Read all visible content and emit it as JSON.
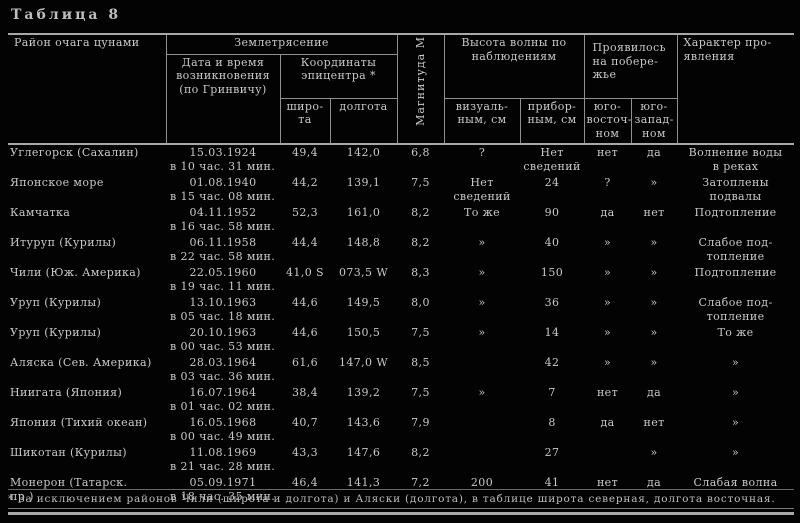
{
  "page": {
    "table_label": "Таблица 8",
    "footnote": "* За исключением районов Чили (широта и долгота) и Аляски (долгота), в таблице широта северная, долгота восточная."
  },
  "colors": {
    "background": "#030303",
    "text": "#c8c8c8",
    "rule": "#a8a8a8"
  },
  "table": {
    "headers": {
      "region": "Район очага цунами",
      "earthquake": "Землетрясение",
      "datetime": "Дата и время\nвозникновения\n(по Гринвичу)",
      "coordinates": "Координаты\nэпицентра *",
      "latitude": "широ-\nта",
      "longitude": "долгота",
      "magnitude": "Магнитуда М",
      "wave_height": "Высота волны по\nнаблюдениям",
      "visual": "визуаль-\nным, см",
      "instrumental": "прибор-\nным, см",
      "coast": "Проявилось\nна побере-\nжье",
      "southeast": "юго-\nвосточ-\nном",
      "southwest": "юго-\nзапад-\nном",
      "character": "Характер про-\nявления"
    },
    "rows": [
      {
        "region": "Углегорск (Сахалин)",
        "date": "15.03.1924",
        "time": "в 10 час. 31 мин.",
        "lat": "49,4",
        "lon": "142,0",
        "mag": "6,8",
        "visual": "?",
        "instr": "Нет\nсведений",
        "se": "нет",
        "sw": "да",
        "character": "Волнение воды\nв реках"
      },
      {
        "region": "Японское море",
        "date": "01.08.1940",
        "time": "в 15 час. 08 мин.",
        "lat": "44,2",
        "lon": "139,1",
        "mag": "7,5",
        "visual": "Нет\nсведений",
        "instr": "24",
        "se": "?",
        "sw": "»",
        "character": "Затоплены\nподвалы"
      },
      {
        "region": "Камчатка",
        "date": "04.11.1952",
        "time": "в 16 час. 58 мин.",
        "lat": "52,3",
        "lon": "161,0",
        "mag": "8,2",
        "visual": "То же",
        "instr": "90",
        "se": "да",
        "sw": "нет",
        "character": "Подтопление"
      },
      {
        "region": "Итуруп (Курилы)",
        "date": "06.11.1958",
        "time": "в 22 час. 58 мин.",
        "lat": "44,4",
        "lon": "148,8",
        "mag": "8,2",
        "visual": "»",
        "instr": "40",
        "se": "»",
        "sw": "»",
        "character": "Слабое под-\nтопление"
      },
      {
        "region": "Чили (Юж. Америка)",
        "date": "22.05.1960",
        "time": "в 19 час. 11 мин.",
        "lat": "41,0 S",
        "lon": "073,5 W",
        "mag": "8,3",
        "visual": "»",
        "instr": "150",
        "se": "»",
        "sw": "»",
        "character": "Подтопление"
      },
      {
        "region": "Уруп (Курилы)",
        "date": "13.10.1963",
        "time": "в 05 час. 18 мин.",
        "lat": "44,6",
        "lon": "149,5",
        "mag": "8,0",
        "visual": "»",
        "instr": "36",
        "se": "»",
        "sw": "»",
        "character": "Слабое под-\nтопление"
      },
      {
        "region": "Уруп (Курилы)",
        "date": "20.10.1963",
        "time": "в 00 час. 53 мин.",
        "lat": "44,6",
        "lon": "150,5",
        "mag": "7,5",
        "visual": "»",
        "instr": "14",
        "se": "»",
        "sw": "»",
        "character": "То же"
      },
      {
        "region": "Аляска (Сев. Америка)",
        "date": "28.03.1964",
        "time": "в 03 час. 36 мин.",
        "lat": "61,6",
        "lon": "147,0 W",
        "mag": "8,5",
        "visual": "",
        "instr": "42",
        "se": "»",
        "sw": "»",
        "character": "»"
      },
      {
        "region": "Ниигата (Япония)",
        "date": "16.07.1964",
        "time": "в 01 час. 02 мин.",
        "lat": "38,4",
        "lon": "139,2",
        "mag": "7,5",
        "visual": "»",
        "instr": "7",
        "se": "нет",
        "sw": "да",
        "character": "»"
      },
      {
        "region": "Япония (Тихий океан)",
        "date": "16.05.1968",
        "time": "в 00 час. 49 мин.",
        "lat": "40,7",
        "lon": "143,6",
        "mag": "7,9",
        "visual": "",
        "instr": "8",
        "se": "да",
        "sw": "нет",
        "character": "»"
      },
      {
        "region": "Шикотан (Курилы)",
        "date": "11.08.1969",
        "time": "в 21 час. 28 мин.",
        "lat": "43,3",
        "lon": "147,6",
        "mag": "8,2",
        "visual": "",
        "instr": "27",
        "se": "",
        "sw": "»",
        "character": "»"
      },
      {
        "region": "Монерон (Татарск.\nпр.)",
        "date": "05.09.1971",
        "time": "в 18 час. 35 мин.",
        "lat": "46,4",
        "lon": "141,3",
        "mag": "7,2",
        "visual": "200",
        "instr": "41",
        "se": "нет",
        "sw": "да",
        "character": "Слабая волна"
      }
    ]
  }
}
